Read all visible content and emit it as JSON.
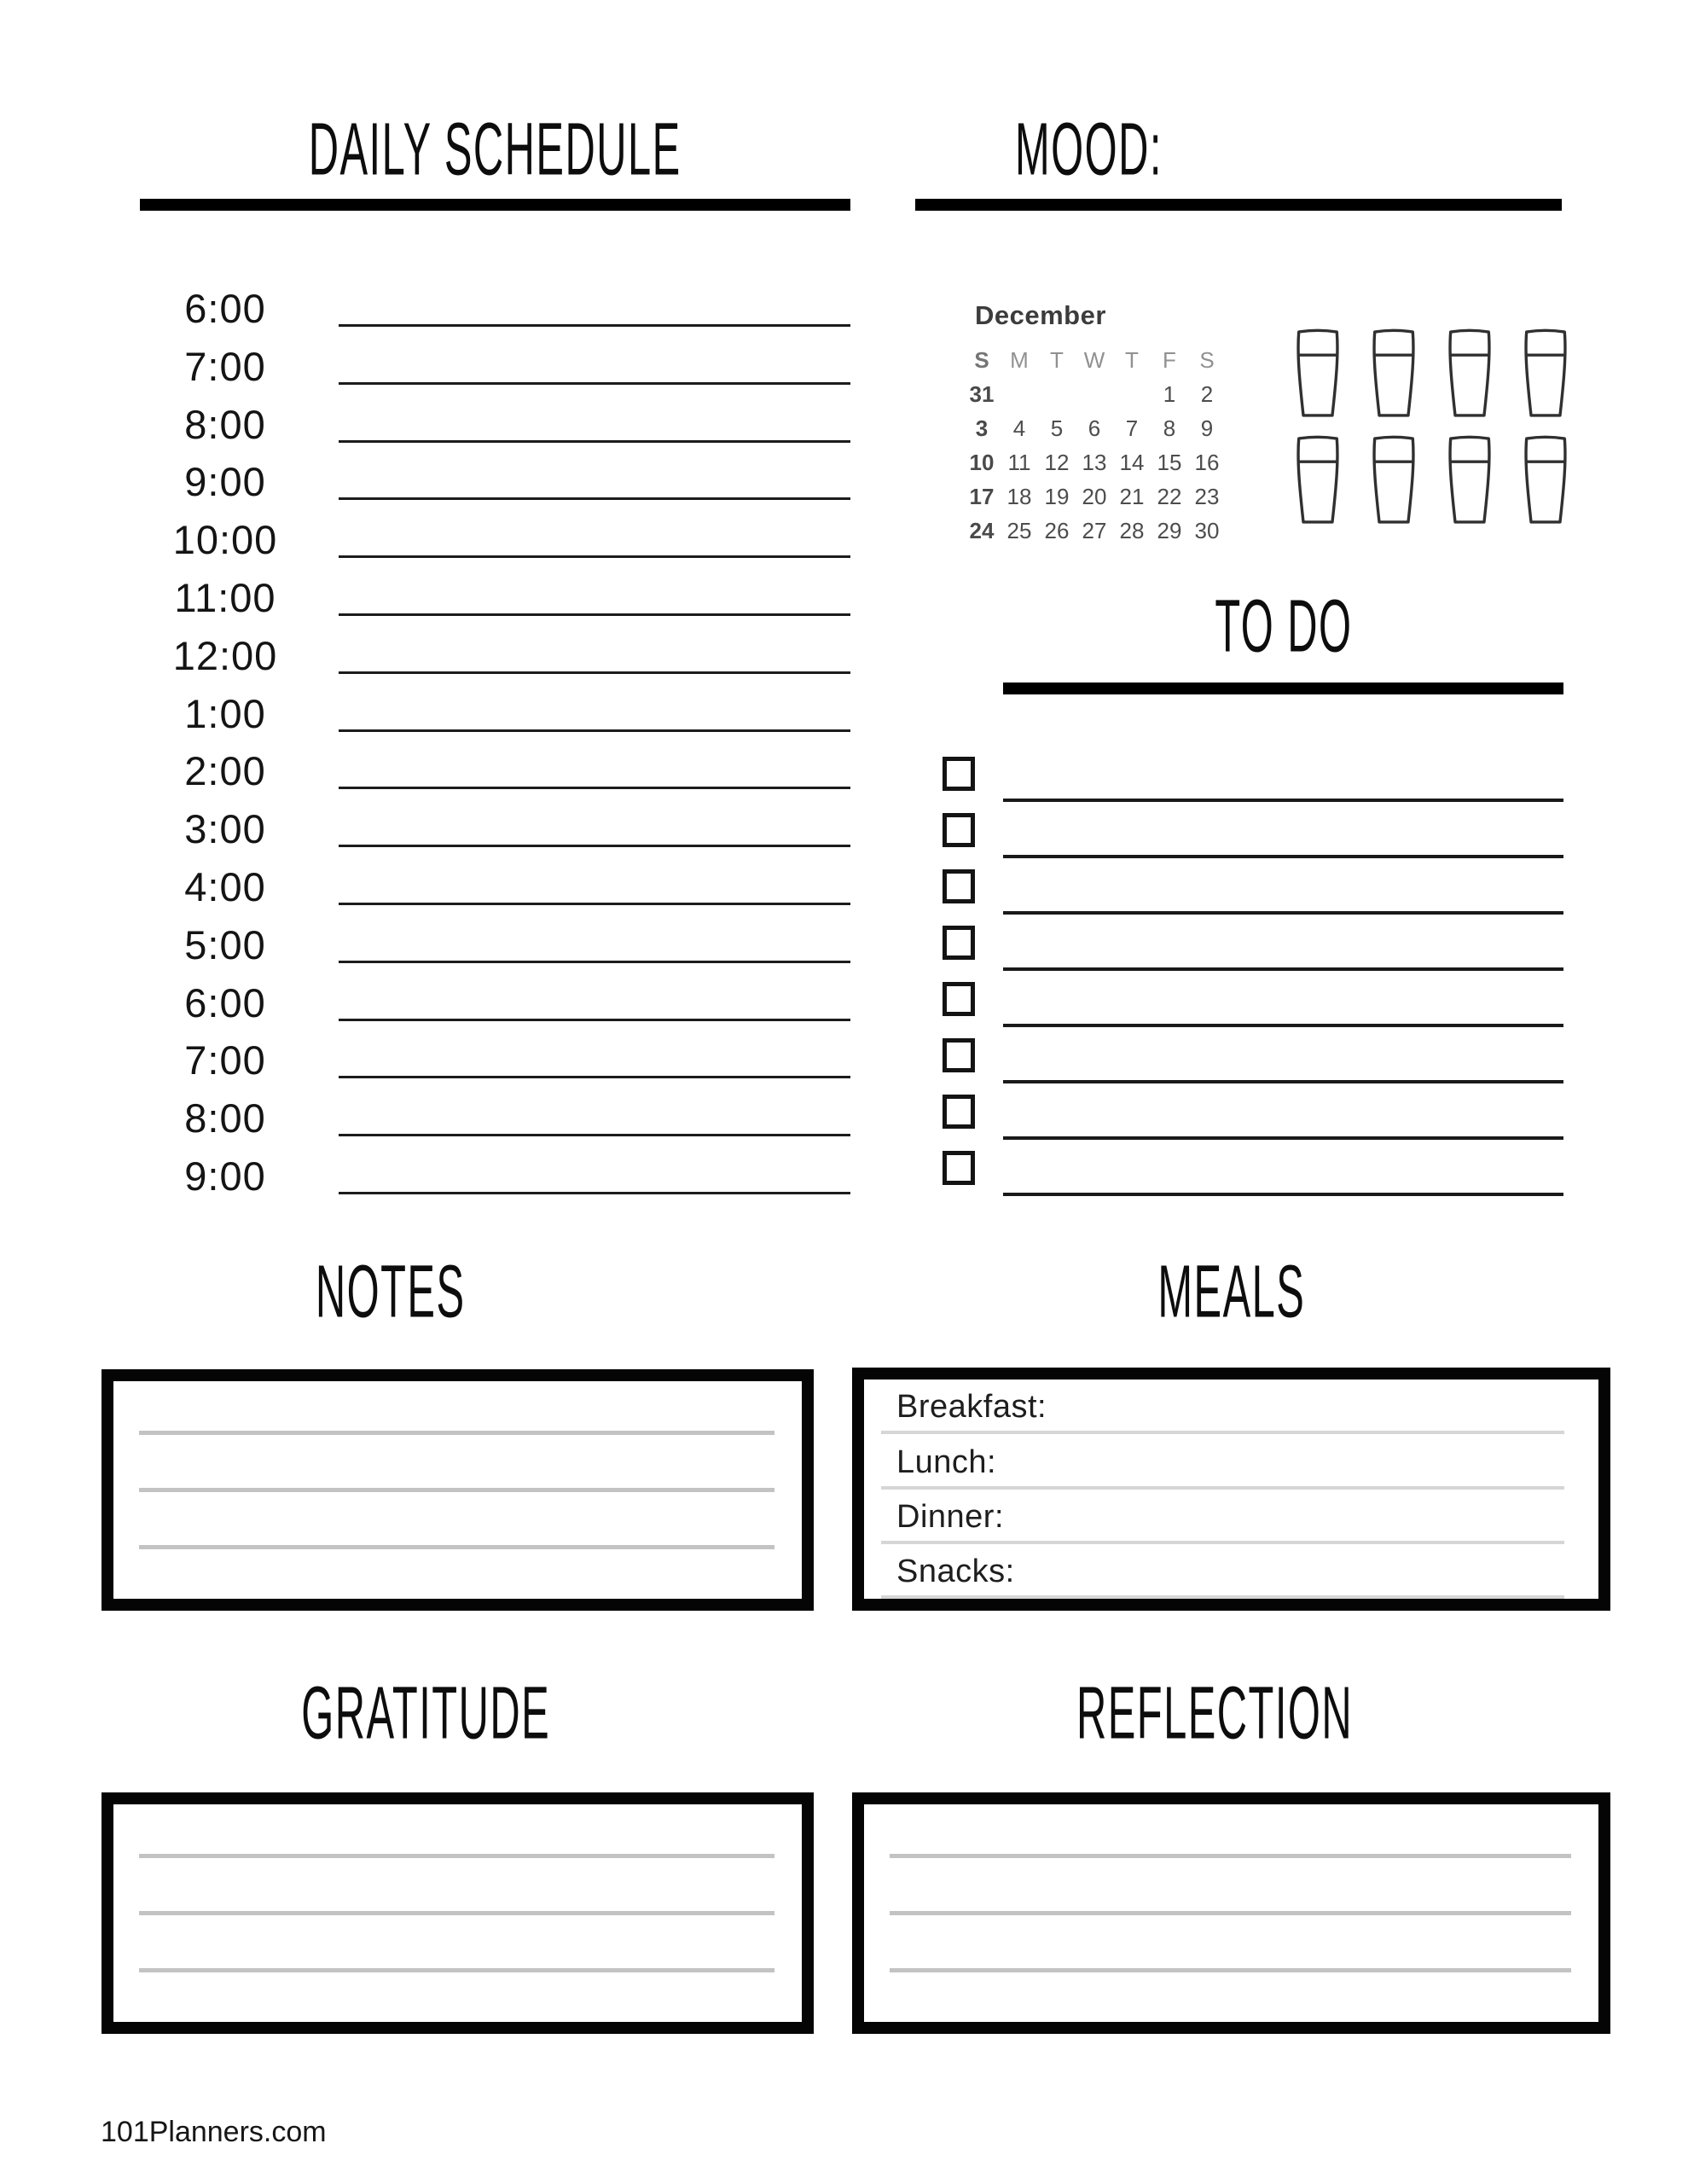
{
  "daily_schedule": {
    "title": "DAILY SCHEDULE",
    "times": [
      "6:00",
      "7:00",
      "8:00",
      "9:00",
      "10:00",
      "11:00",
      "12:00",
      "1:00",
      "2:00",
      "3:00",
      "4:00",
      "5:00",
      "6:00",
      "7:00",
      "8:00",
      "9:00"
    ],
    "entry_value": ""
  },
  "mood": {
    "title": "MOOD:",
    "value": "",
    "cups": [
      "cup-1",
      "cup-2",
      "cup-3",
      "cup-4",
      "cup-5",
      "cup-6",
      "cup-7",
      "cup-8"
    ]
  },
  "calendar": {
    "month": "December",
    "cells": [
      {
        "t": "S",
        "c": "hdr1"
      },
      {
        "t": "M",
        "c": "hdr"
      },
      {
        "t": "T",
        "c": "hdr"
      },
      {
        "t": "W",
        "c": "hdr"
      },
      {
        "t": "T",
        "c": "hdr"
      },
      {
        "t": "F",
        "c": "hdr"
      },
      {
        "t": "S",
        "c": "hdr"
      },
      {
        "t": "31",
        "c": "sun"
      },
      {
        "t": ""
      },
      {
        "t": ""
      },
      {
        "t": ""
      },
      {
        "t": ""
      },
      {
        "t": "1"
      },
      {
        "t": "2"
      },
      {
        "t": "3",
        "c": "sun"
      },
      {
        "t": "4"
      },
      {
        "t": "5"
      },
      {
        "t": "6"
      },
      {
        "t": "7"
      },
      {
        "t": "8"
      },
      {
        "t": "9"
      },
      {
        "t": "10",
        "c": "sun"
      },
      {
        "t": "11"
      },
      {
        "t": "12"
      },
      {
        "t": "13"
      },
      {
        "t": "14"
      },
      {
        "t": "15"
      },
      {
        "t": "16"
      },
      {
        "t": "17",
        "c": "sun"
      },
      {
        "t": "18"
      },
      {
        "t": "19"
      },
      {
        "t": "20"
      },
      {
        "t": "21"
      },
      {
        "t": "22"
      },
      {
        "t": "23"
      },
      {
        "t": "24",
        "c": "sun"
      },
      {
        "t": "25"
      },
      {
        "t": "26"
      },
      {
        "t": "27"
      },
      {
        "t": "28"
      },
      {
        "t": "29"
      },
      {
        "t": "30"
      }
    ]
  },
  "todo": {
    "title": "TO DO",
    "items": [
      "",
      "",
      "",
      "",
      "",
      "",
      "",
      ""
    ]
  },
  "notes": {
    "title": "NOTES",
    "lines": [
      "",
      "",
      ""
    ]
  },
  "meals": {
    "title": "MEALS",
    "rows": [
      "Breakfast:",
      "Lunch:",
      "Dinner:",
      "Snacks:"
    ]
  },
  "gratitude": {
    "title": "GRATITUDE",
    "lines": [
      "",
      "",
      ""
    ]
  },
  "reflection": {
    "title": "REFLECTION",
    "lines": [
      "",
      "",
      ""
    ]
  },
  "footer": {
    "site": "101Planners.com"
  },
  "colors": {
    "ink": "#111111",
    "bar": "#000000",
    "calendar_gray": "#4d4d4d",
    "calendar_header_gray": "#919191",
    "rule_gray": "#c3c3c3",
    "meal_rule_gray": "#d6d6d6"
  }
}
